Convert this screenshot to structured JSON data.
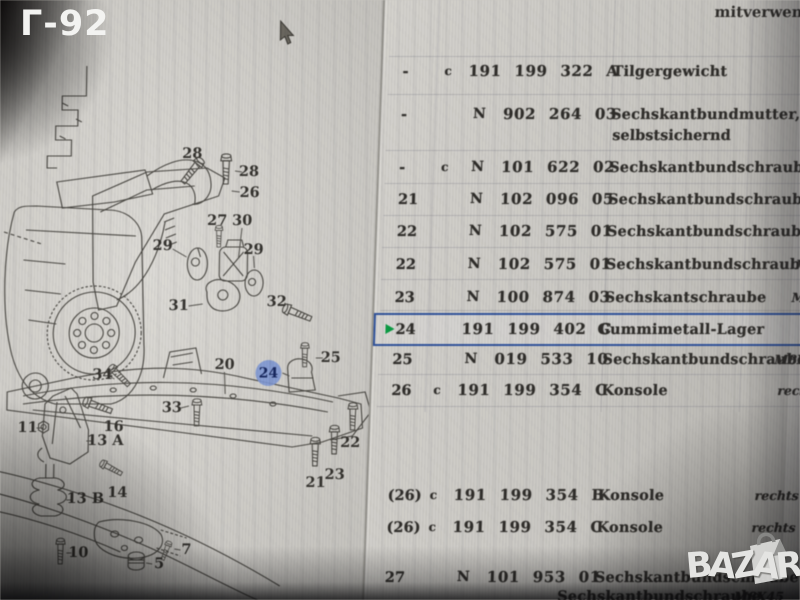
{
  "overlay": {
    "photo_label": "Г-92",
    "watermark": "BAZAR"
  },
  "table": {
    "top_remark": "mitverwen",
    "rows": [
      {
        "pos": "-",
        "flag": "c",
        "num": "191 199 322 A",
        "name": "Tilgergewicht",
        "top": 63
      },
      {
        "pos": "-",
        "pre": "N",
        "num": "902 264 03",
        "name": "Sechskantbundmutter,",
        "name2": "selbstsichernd",
        "top": 106
      },
      {
        "pos": "-",
        "flag": "c",
        "pre": "N",
        "num": "101 622 02",
        "name": "Sechskantbundschraube",
        "top": 159
      },
      {
        "pos": "21",
        "pre": "N",
        "num": "102 096 05",
        "name": "Sechskantbundschraube",
        "top": 191
      },
      {
        "pos": "22",
        "pre": "N",
        "num": "102 575 01",
        "name": "Sechskantbundschraube",
        "top": 223
      },
      {
        "pos": "22",
        "pre": "N",
        "num": "102 575 01",
        "name": "Sechskantbundschraube",
        "rem": "M",
        "rx": 420,
        "top": 256
      },
      {
        "pos": "23",
        "pre": "N",
        "num": "100 874 03",
        "name": "Sechskantschraube",
        "rem": "M",
        "rx": 417,
        "top": 289
      },
      {
        "pos": "24",
        "num": "191 199 402 C",
        "name": "Gummimetall-Lager",
        "nx": 222,
        "hl": true,
        "top": 313
      },
      {
        "pos": "25",
        "pre": "N",
        "num": "019 533 10",
        "name": "Sechskantbundschraube",
        "rem": "M8X",
        "rx": 402,
        "top": 351
      },
      {
        "pos": "26",
        "flag": "c",
        "num": "191 199 354 C",
        "name": "Konsole",
        "rem": "recht",
        "rx": 406,
        "top": 382
      },
      {
        "pos": "(26)",
        "flag": "c",
        "num": "191 199 354 B",
        "name": "Konsole",
        "rem": "rechts",
        "rx": 387,
        "top": 487
      },
      {
        "pos": "(26)",
        "flag": "c",
        "num": "191 199 354 C",
        "name": "Konsole",
        "rem": "rechts",
        "rx": 385,
        "top": 519
      },
      {
        "pos": "27",
        "pre": "N",
        "num": "101 953 01",
        "name": "Sechskantbundschraube",
        "top": 569
      },
      {
        "name": "Sechskantbundschraube",
        "nx": 193,
        "rem": "M8X45",
        "rx": 370,
        "top": 588
      }
    ]
  },
  "diagram": {
    "callouts": [
      {
        "t": "28",
        "x": 195,
        "y": 154,
        "l": [
          197,
          161,
          202,
          168
        ]
      },
      {
        "t": "28",
        "x": 252,
        "y": 172,
        "l": [
          238,
          171,
          245,
          172
        ]
      },
      {
        "t": "26",
        "x": 253,
        "y": 193,
        "l": [
          235,
          191,
          243,
          192
        ]
      },
      {
        "t": "27",
        "x": 221,
        "y": 221
      },
      {
        "t": "30",
        "x": 246,
        "y": 221,
        "l": [
          246,
          228,
          243,
          258
        ]
      },
      {
        "t": "29",
        "x": 167,
        "y": 246,
        "l": [
          177,
          249,
          191,
          257
        ]
      },
      {
        "t": "29",
        "x": 258,
        "y": 250,
        "l": [
          258,
          256,
          259,
          268
        ]
      },
      {
        "t": "31",
        "x": 184,
        "y": 306,
        "l": [
          194,
          306,
          208,
          304
        ]
      },
      {
        "t": "32",
        "x": 282,
        "y": 302
      },
      {
        "t": "20",
        "x": 231,
        "y": 365,
        "l": [
          231,
          372,
          232,
          394
        ]
      },
      {
        "t": "25",
        "x": 337,
        "y": 358,
        "l": [
          322,
          358,
          329,
          358
        ]
      },
      {
        "t": "33",
        "x": 179,
        "y": 408,
        "l": [
          188,
          408,
          196,
          406
        ]
      },
      {
        "t": "34",
        "x": 109,
        "y": 375,
        "l": [
          116,
          376,
          121,
          379
        ]
      },
      {
        "t": "22",
        "x": 358,
        "y": 443
      },
      {
        "t": "23",
        "x": 343,
        "y": 475
      },
      {
        "t": "21",
        "x": 324,
        "y": 483
      },
      {
        "t": "11",
        "x": 35,
        "y": 428,
        "l": [
          44,
          428,
          50,
          428
        ]
      },
      {
        "t": "16",
        "x": 121,
        "y": 427
      },
      {
        "t": "13 A",
        "x": 113,
        "y": 441,
        "l": [
          101,
          441,
          94,
          441
        ]
      },
      {
        "t": "14",
        "x": 126,
        "y": 493
      },
      {
        "t": "13 B",
        "x": 94,
        "y": 499,
        "l": [
          81,
          500,
          75,
          500
        ]
      },
      {
        "t": "10",
        "x": 88,
        "y": 553,
        "l": [
          81,
          553,
          76,
          553
        ]
      },
      {
        "t": "7",
        "x": 196,
        "y": 550,
        "l": [
          190,
          550,
          184,
          549
        ]
      },
      {
        "t": "5",
        "x": 169,
        "y": 564,
        "l": [
          162,
          564,
          156,
          563
        ]
      }
    ],
    "highlight_callout": {
      "t": "24",
      "x": 275,
      "y": 373,
      "r": 13,
      "l": [
        289,
        373,
        296,
        376
      ]
    },
    "highlight_color": "#7e97d3",
    "selection_border_color": "#32549c",
    "selection_arrow_color": "#0b9c44"
  }
}
